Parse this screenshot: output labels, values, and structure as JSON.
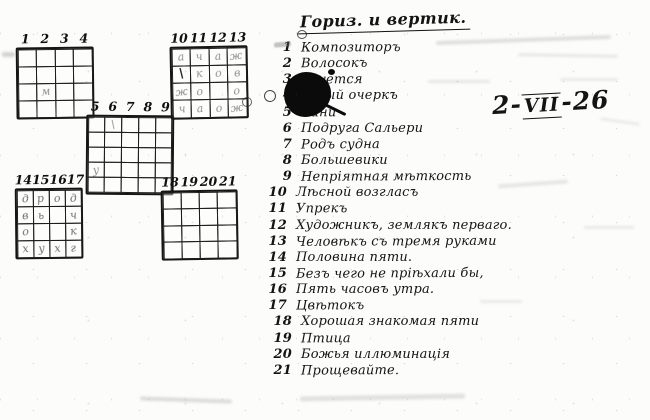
{
  "title": "Гориз. и вертик.",
  "date": {
    "prefix": "2-",
    "roman": "VII",
    "suffix": "-26"
  },
  "clues": [
    {
      "num": "1",
      "text": "Композиторъ"
    },
    {
      "num": "2",
      "text": "Волосокъ"
    },
    {
      "num": "3",
      "text": "лнуется"
    },
    {
      "num": "4",
      "text": "узный очеркъ"
    },
    {
      "num": "5",
      "text": "Сани"
    },
    {
      "num": "6",
      "text": "Подруга Сальери"
    },
    {
      "num": "7",
      "text": "Родъ судна"
    },
    {
      "num": "8",
      "text": "Большевики"
    },
    {
      "num": "9",
      "text": "Непріятная мѣткость"
    },
    {
      "num": "10",
      "text": "Лѣсной возгласъ"
    },
    {
      "num": "11",
      "text": "Упрекъ"
    },
    {
      "num": "12",
      "text": "Художникъ, землякъ перваго."
    },
    {
      "num": "13",
      "text": "Человѣкъ съ тремя руками"
    },
    {
      "num": "14",
      "text": "Половина пяти."
    },
    {
      "num": "15",
      "text": "Безъ чего не пріѣхали бы,"
    },
    {
      "num": "16",
      "text": "Пять часовъ утра."
    },
    {
      "num": "17",
      "text": "Цвѣтокъ"
    },
    {
      "num": "18",
      "text": "Хорошая знакомая пяти"
    },
    {
      "num": "19",
      "text": "Птица"
    },
    {
      "num": "20",
      "text": "Божья иллюминація"
    },
    {
      "num": "21",
      "text": "Прощевайте."
    }
  ],
  "grids": [
    {
      "id": "top-left",
      "numbers": [
        "1",
        "2",
        "3",
        "4"
      ],
      "cols": 4,
      "rows": 4,
      "letters": [
        [
          "",
          "",
          "",
          ""
        ],
        [
          "",
          "",
          "",
          ""
        ],
        [
          "",
          "м",
          "",
          ""
        ],
        [
          "",
          "",
          "",
          ""
        ]
      ]
    },
    {
      "id": "middle",
      "numbers": [
        "5",
        "6",
        "7",
        "8",
        "9"
      ],
      "cols": 5,
      "rows": 5,
      "letters": [
        [
          "",
          "\\",
          "",
          "",
          ""
        ],
        [
          "",
          "",
          "",
          "",
          ""
        ],
        [
          "",
          "",
          "",
          "",
          ""
        ],
        [
          "у",
          "",
          "",
          "",
          ""
        ],
        [
          "",
          "",
          "",
          "",
          ""
        ]
      ]
    },
    {
      "id": "top-right",
      "numbers": [
        "10",
        "11",
        "12",
        "13"
      ],
      "cols": 4,
      "rows": 4,
      "letters": [
        [
          "а",
          "ч",
          "а",
          "ж"
        ],
        [
          "!\\",
          "к",
          "о",
          "в"
        ],
        [
          "ж",
          "о",
          "",
          "о"
        ],
        [
          "ч",
          "а",
          "о",
          "ж"
        ]
      ]
    },
    {
      "id": "bottom-left",
      "numbers": [
        "14",
        "15",
        "16",
        "17"
      ],
      "cols": 4,
      "rows": 4,
      "letters": [
        [
          "д",
          "р",
          "о",
          "д"
        ],
        [
          "в",
          "ь",
          "",
          "ч"
        ],
        [
          "о",
          "",
          "",
          "к"
        ],
        [
          "х",
          "у",
          "х",
          "г"
        ]
      ]
    },
    {
      "id": "bottom-right",
      "numbers": [
        "18",
        "19",
        "20",
        "21"
      ],
      "cols": 4,
      "rows": 4,
      "letters": [
        [
          "",
          "",
          "",
          ""
        ],
        [
          "",
          "",
          "",
          ""
        ],
        [
          "",
          "",
          "",
          ""
        ],
        [
          "",
          "",
          "",
          ""
        ]
      ]
    }
  ],
  "colors": {
    "ink": "#141414",
    "pencil": "#8f8f8f",
    "paper": "#fcfcfa"
  }
}
